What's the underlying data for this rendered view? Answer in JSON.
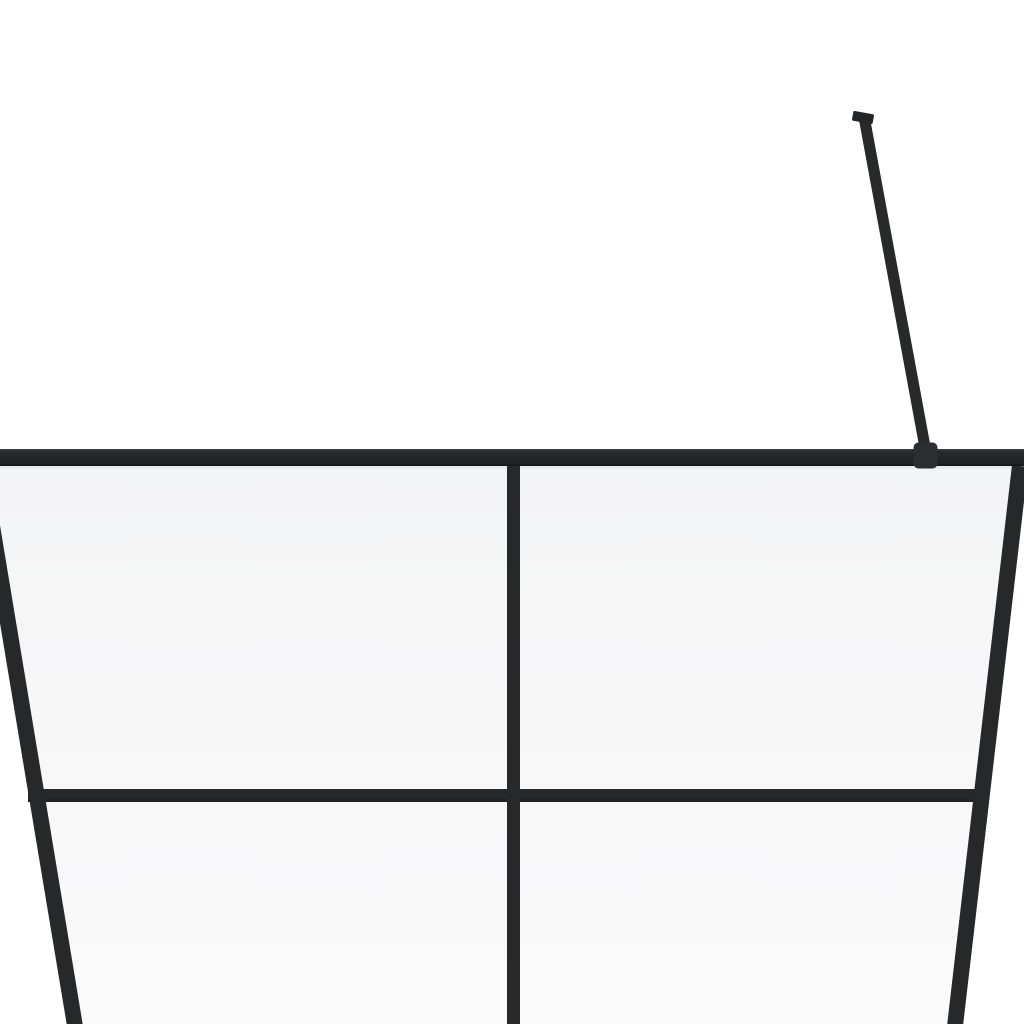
{
  "scene": {
    "subject": "walk-in-shower-glass-wall-with-black-frame",
    "description": "Product render: upper portion of a framed walk-in shower glass panel (4-pane grid) with a diagonal stabilizer support arm clamped to the top rail, on a plain white background",
    "colors": {
      "background": "#ffffff",
      "glass": "#f6f6f7",
      "glass_bottom": "#fafafb",
      "glass_top_edge": "#e9eaec",
      "frame": "#26282a",
      "frame_dark": "#1b1d1f",
      "frame_top_highlight": "#4a4d50",
      "frame_bottom_shadow": "#131416",
      "bracket": "#2b2d30",
      "arm": "#27292b",
      "arm_cap": "#232528"
    },
    "parts": {
      "glass_panel": "clear glass panel (slightly grey, tapering in perspective)",
      "top_rail": "horizontal black top frame rail, full image width",
      "left_rail": "left frame rail, slanting right toward bottom",
      "right_rail": "right frame rail, slanting left toward bottom",
      "center_mullion": "vertical black divider bar at center",
      "middle_transom": "horizontal black divider bar across middle",
      "support_arm": "diagonal stabilizer bar rising to upper right",
      "support_arm_cap": "wall/ceiling mount cap at top of stabilizer bar",
      "support_arm_bracket": "clamp bracket joining stabilizer bar to top rail"
    }
  }
}
